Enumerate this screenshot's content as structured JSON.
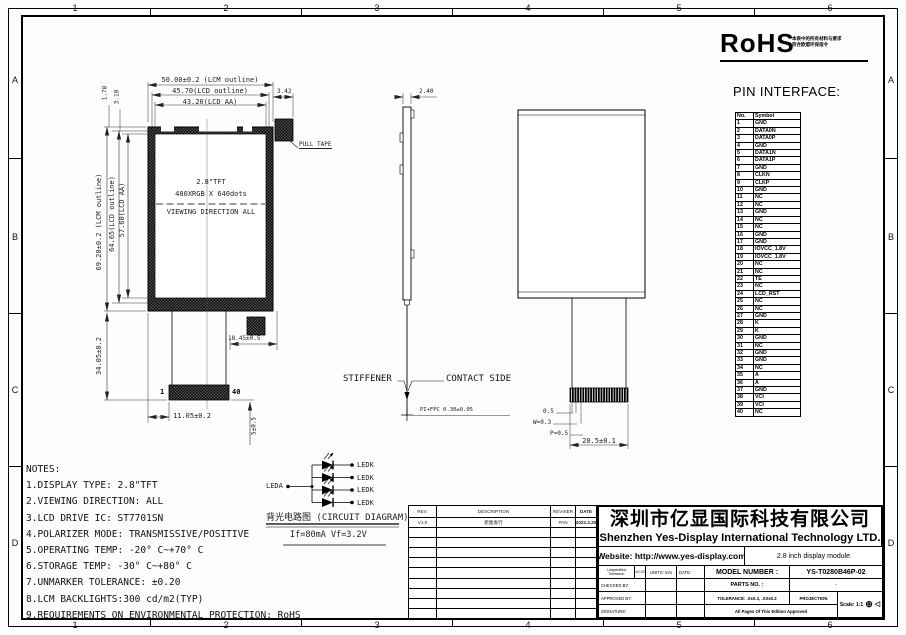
{
  "sheet": {
    "zone_numbers": [
      "1",
      "2",
      "3",
      "4",
      "5",
      "6"
    ],
    "zone_letters": [
      "A",
      "B",
      "C",
      "D"
    ]
  },
  "rohs": {
    "logo": "RoHS",
    "cn_line1": "本表中的所有材料与要求",
    "cn_line2": "符合欧盟环保指令"
  },
  "pin_interface": {
    "title": "PIN INTERFACE:",
    "col_no": "No.",
    "col_symbol": "Symbol",
    "pins": [
      [
        "1",
        "GND"
      ],
      [
        "2",
        "DATA0N"
      ],
      [
        "3",
        "DATA0P"
      ],
      [
        "4",
        "GND"
      ],
      [
        "5",
        "DATA1N"
      ],
      [
        "6",
        "DATA1P"
      ],
      [
        "7",
        "GND"
      ],
      [
        "8",
        "CLKN"
      ],
      [
        "9",
        "CLKP"
      ],
      [
        "10",
        "GND"
      ],
      [
        "11",
        "NC"
      ],
      [
        "12",
        "NC"
      ],
      [
        "13",
        "GND"
      ],
      [
        "14",
        "NC"
      ],
      [
        "15",
        "NC"
      ],
      [
        "16",
        "GND"
      ],
      [
        "17",
        "GND"
      ],
      [
        "18",
        "IOVCC_1.8V"
      ],
      [
        "19",
        "IOVCC_1.8V"
      ],
      [
        "20",
        "NC"
      ],
      [
        "21",
        "NC"
      ],
      [
        "22",
        "TE"
      ],
      [
        "23",
        "NC"
      ],
      [
        "24",
        "LCD_RST"
      ],
      [
        "25",
        "NC"
      ],
      [
        "26",
        "NC"
      ],
      [
        "27",
        "GND"
      ],
      [
        "28",
        "K"
      ],
      [
        "29",
        "K"
      ],
      [
        "30",
        "GND"
      ],
      [
        "31",
        "NC"
      ],
      [
        "32",
        "GND"
      ],
      [
        "33",
        "GND"
      ],
      [
        "34",
        "NC"
      ],
      [
        "35",
        "A"
      ],
      [
        "36",
        "A"
      ],
      [
        "37",
        "GND"
      ],
      [
        "38",
        "VCI"
      ],
      [
        "39",
        "VCI"
      ],
      [
        "40",
        "NC"
      ]
    ]
  },
  "front_view": {
    "dims_top": [
      "50.00±0.2 (LCM outline)",
      "45.70(LCD outline)",
      "43.20(LCD AA)"
    ],
    "dim_178": "1.78",
    "dim_310": "3.10",
    "dim_342": "3.42",
    "dims_left": [
      "69.20±0.2 (LCM outline)",
      "64.65(LCD outline)",
      "57.60(LCD AA)"
    ],
    "dim_3405": "34.05±0.2",
    "pull_tape": "PULL TAPE",
    "panel_line1": "2.8\"TFT",
    "panel_line2": "480XRGB X 640dots",
    "viewing": "VIEWING DIRECTION ALL",
    "pin1": "1",
    "pin40": "40",
    "dim_1105": "11.05±0.2",
    "dim_1845": "18.45±0.5",
    "dim_5": "5±0.5"
  },
  "side_view": {
    "dim_240": "2.40",
    "stiffener": "STIFFENER",
    "contact": "CONTACT SIDE",
    "fpc": "PI+FPC 0.30±0.05"
  },
  "back_view": {
    "dim_05": "0.5",
    "dim_w": "W=0.3",
    "dim_p": "P=0.5",
    "dim_205": "20.5±0.1"
  },
  "circuit": {
    "leda": "LEDA",
    "ledk": [
      "LEDK",
      "LEDK",
      "LEDK",
      "LEDK"
    ],
    "caption": "背光电路图 (CIRCUIT DIAGRAM)",
    "spec": "If=80mA Vf=3.2V"
  },
  "notes": {
    "title": "NOTES:",
    "items": [
      "1.DISPLAY TYPE:  2.8\"TFT",
      "2.VIEWING DIRECTION: ALL",
      "3.LCD DRIVE IC: ST7701SN",
      "4.POLARIZER MODE: TRANSMISSIVE/POSITIVE",
      "5.OPERATING TEMP: -20° C~+70° C",
      "6.STORAGE TEMP: -30° C~+80° C",
      "7.UNMARKER TOLERANCE: ±0.20",
      "8.LCM BACKLIGHTS:300 cd/m2(TYP)",
      "9.REQUIREMENTS ON ENVIRONMENTAL PROTECTION: RoHS"
    ]
  },
  "revision_table": {
    "headers": [
      "REV.",
      "DESCRIPTION",
      "REVISER",
      "DATE"
    ],
    "rows": [
      [
        "V1.0",
        "新图发行",
        "PAN",
        "2022.3.20"
      ]
    ],
    "empty_rows": 9
  },
  "title_block": {
    "company_cn": "深圳市亿显国际科技有限公司",
    "company_en": "Shenzhen Yes-Display International Technology LTD.",
    "website": "Website: http://www.yes-display.com",
    "product": "2.8 inch display module",
    "unspecified_tolerance_label": "Unspecified Tolerance:",
    "unspecified_tolerance_value": "±0.20",
    "units": "UNITS: mm",
    "date_label": "DATE:",
    "model_number_label": "MODEL NUMBER :",
    "model_number": "YS-T0280B46P-02",
    "checked_by": "CHECKED  BY:",
    "approved_by": "APPROVED BY:",
    "signature": "SIGNATURE:",
    "parts_no_label": "PARTS NO. :",
    "parts_no": "-",
    "tolerance": "TOLERANCE: .X±0.3, .XX±0.2",
    "projection": "PROJECTION",
    "scale": "Scale: 1:1",
    "projection_symbol": "⊕",
    "projection_symbol2": "◁",
    "approved_note": "All Pages Of This Edition Approved"
  },
  "colors": {
    "ink": "#000000",
    "dim": "#2a2a2a",
    "paper": "#fdfdfd"
  }
}
